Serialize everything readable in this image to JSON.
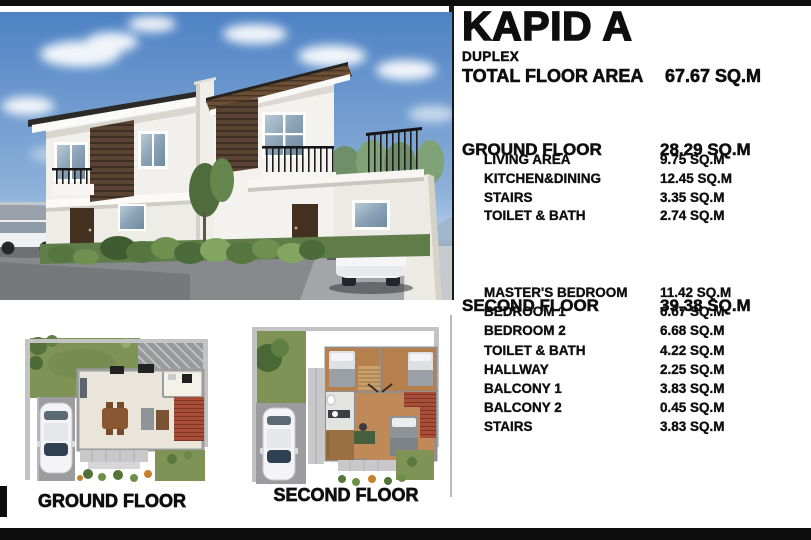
{
  "panel": {
    "title": "KAPID A",
    "subtitle": "DUPLEX",
    "total": {
      "label": "TOTAL FLOOR AREA",
      "value": "67.67 SQ.M"
    },
    "sections": [
      {
        "label": "GROUND FLOOR",
        "value": "28.29 SQ.M",
        "items": [
          {
            "label": "LIVING AREA",
            "value": "9.75 SQ.M"
          },
          {
            "label": "KITCHEN&DINING",
            "value": "12.45 SQ.M"
          },
          {
            "label": "STAIRS",
            "value": "3.35 SQ.M"
          },
          {
            "label": "TOILET & BATH",
            "value": "2.74 SQ.M"
          }
        ]
      },
      {
        "label": "SECOND FLOOR",
        "value": "39.38 SQ.M",
        "items": [
          {
            "label": "MASTER'S BEDROOM",
            "value": "11.42 SQ.M"
          },
          {
            "label": "BEDROOM 1",
            "value": "6.67 SQ.M"
          },
          {
            "label": "BEDROOM 2",
            "value": "6.68 SQ.M"
          },
          {
            "label": "TOILET & BATH",
            "value": "4.22 SQ.M"
          },
          {
            "label": "HALLWAY",
            "value": "2.25 SQ.M"
          },
          {
            "label": "BALCONY 1",
            "value": "3.83 SQ.M"
          },
          {
            "label": "BALCONY 2",
            "value": "0.45 SQ.M"
          },
          {
            "label": "STAIRS",
            "value": "3.83 SQ.M"
          }
        ]
      }
    ]
  },
  "plans": {
    "ground_label": "GROUND FLOOR",
    "second_label": "SECOND FLOOR"
  },
  "colors": {
    "bar_black": "#0d0d0d",
    "paper_white": "#ffffff",
    "sky_blue": "#4e82c4",
    "grass_green": "#7e9355",
    "tile_red": "#a84d37",
    "wood_brown": "#5a4333"
  }
}
